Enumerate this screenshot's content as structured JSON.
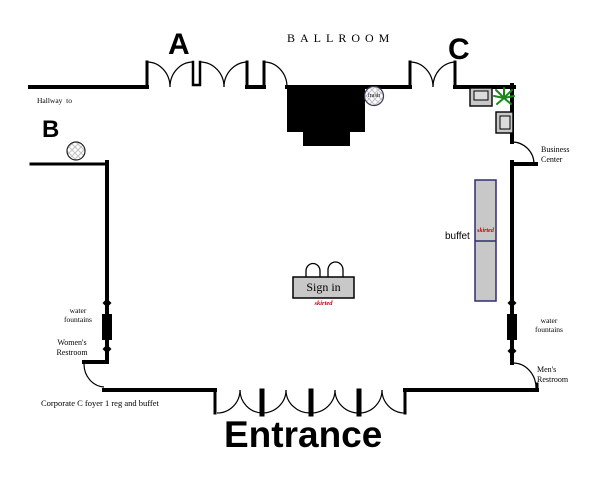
{
  "labels": {
    "zone_a": "A",
    "zone_b": "B",
    "zone_c": "C",
    "ballroom": "BALLROOM",
    "hallway_to": "Hallway  to",
    "business_center": "Business\nCenter",
    "buffet": "buffet",
    "buffet_skirted": "skirted",
    "sign_in": "Sign in",
    "sign_in_skirted": "skirted",
    "water_fountains_left": "water\nfountains",
    "water_fountains_right": "water\nfountains",
    "womens_restroom": "Women's\nRestroom",
    "mens_restroom": "Men's\nRestroom",
    "corporate_note": "Corporate C foyer 1 reg and buffet",
    "entrance": "Entrance",
    "trash": "trash"
  },
  "icons": {
    "plant": "potted-plant",
    "chair_top": "armchair-top-view",
    "chair_side": "armchair-top-view",
    "trash_can": "crosshatched-circle",
    "column_b": "crosshatched-circle"
  },
  "colors": {
    "wall": "#000000",
    "stage": "#000000",
    "table_fill": "#c8c8c8",
    "buffet_border": "#2e2e70",
    "skirted_text": "#cc0000",
    "plant_green": "#17891b"
  }
}
